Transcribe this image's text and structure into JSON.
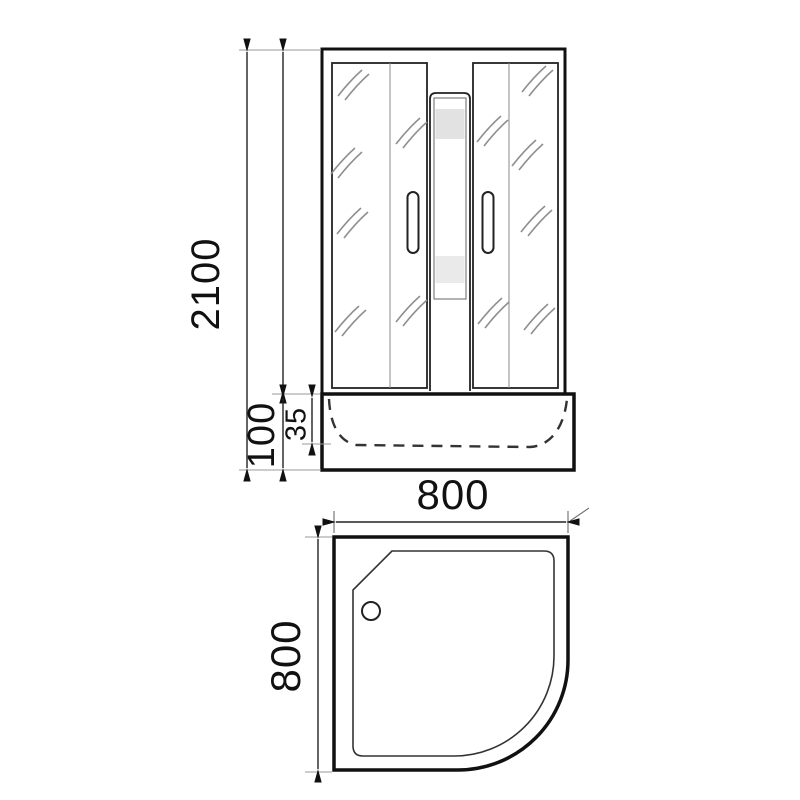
{
  "drawing": {
    "views": {
      "front": "front-elevation-shower-cabin",
      "plan": "plan-view-quarter-round-tray"
    },
    "dimensions": {
      "overall_height": "2100",
      "tray_height": "100",
      "tray_rim_depth": "35",
      "width": "800",
      "depth": "800"
    },
    "colors": {
      "line": "#111111",
      "thin_line": "#333333",
      "extension_line": "#9a9a9a",
      "glass_mark": "#8f8f8f",
      "panel_band_top": "#e2e2e2",
      "panel_band_bottom": "#eaeaea",
      "background": "#ffffff"
    }
  }
}
